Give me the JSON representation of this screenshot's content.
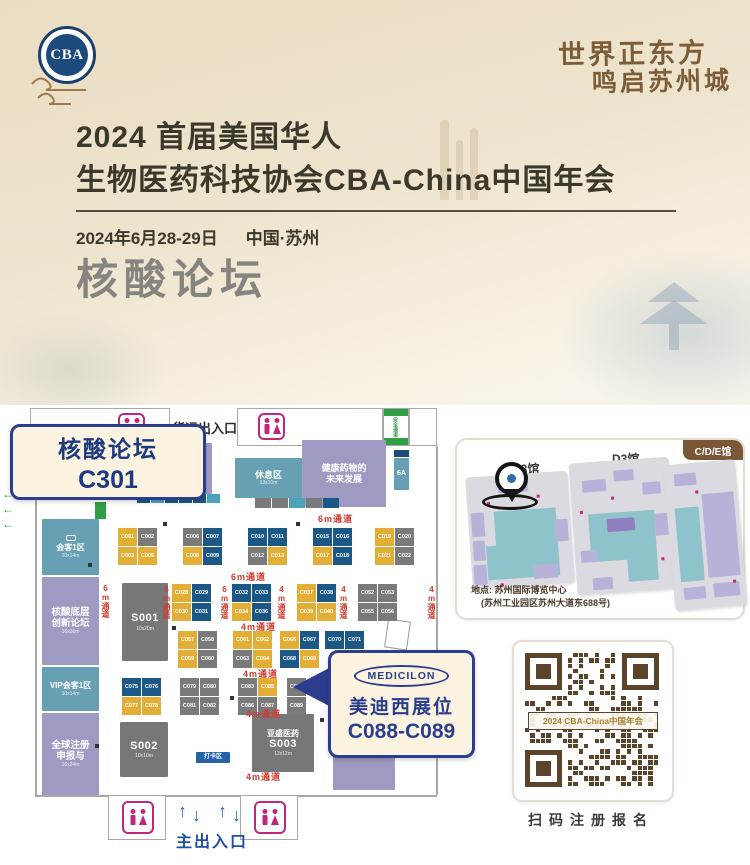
{
  "colors": {
    "accent_navy": "#2b3e8e",
    "booth_yellow": "#e3ae36",
    "booth_blue": "#1b5886",
    "booth_gray": "#7a7a7a",
    "zone_purple": "#9e9bc2",
    "zone_teal": "#66a0b2",
    "aisle_red": "#d23b2e",
    "green": "#2f9e44",
    "wc_pink": "#c0267c",
    "qr_brown": "#5a452a",
    "badge_brown": "#7a5837"
  },
  "icons": {
    "left_arrow": "←",
    "up_arrow": "↑",
    "down_arrow": "↓"
  },
  "header": {
    "logo": "CBA",
    "calligraphy": [
      "世界正东方",
      "鸣启苏州城"
    ],
    "title1": "2024 首届美国华人",
    "title2": "生物医药科技协会CBA-China中国年会",
    "date": "2024年6月28-29日",
    "city": "中国·苏州",
    "forum": "核酸论坛"
  },
  "floorplan": {
    "labels": {
      "freight": "货运出入口",
      "safety": "安全通道",
      "main_exit": "主出入口"
    },
    "callout": {
      "line1": "核酸论坛",
      "line2": "C301"
    },
    "medicilon": {
      "logo": "MEDICILON",
      "line1": "美迪西展位",
      "line2": "C088-C089"
    },
    "zones": [
      {
        "name": "zhongshan",
        "t": "中山大学 A联合体",
        "c": "C306",
        "s": "16x10m",
        "cls": "purple",
        "x": 115,
        "y": 38,
        "w": 97,
        "h": 51
      },
      {
        "name": "rest-area",
        "t": "休息区",
        "s": "13x10m",
        "cls": "teal",
        "x": 235,
        "y": 53,
        "w": 67,
        "h": 40
      },
      {
        "name": "future-forum",
        "t": "健康药物的未来发展",
        "cls": "purple",
        "x": 302,
        "y": 35,
        "w": 84,
        "h": 67
      },
      {
        "name": "meeting-1",
        "t": "会客1区",
        "s": "10x14m",
        "cls": "teal",
        "x": 42,
        "y": 114,
        "w": 57,
        "h": 56,
        "icon": "sofa"
      },
      {
        "name": "nucleic-bottom-forum",
        "t": "核酸底层创新论坛",
        "s": "16x26m",
        "cls": "purple",
        "x": 42,
        "y": 172,
        "w": 57,
        "h": 88
      },
      {
        "name": "vip-meeting",
        "t": "VIP会客1区",
        "s": "10x14m",
        "cls": "teal",
        "x": 42,
        "y": 262,
        "w": 57,
        "h": 44
      },
      {
        "name": "global-reg",
        "t": "全球注册申报与",
        "s": "16x24m",
        "cls": "purple",
        "x": 42,
        "y": 308,
        "w": 57,
        "h": 82
      },
      {
        "name": "s001",
        "c": "S001",
        "s": "10x20m",
        "cls": "gray",
        "x": 122,
        "y": 178,
        "w": 46,
        "h": 78
      },
      {
        "name": "s002",
        "c": "S002",
        "s": "10x10m",
        "cls": "gray",
        "x": 120,
        "y": 317,
        "w": 48,
        "h": 55
      },
      {
        "name": "s003",
        "t": "亚盛医药",
        "c": "S003",
        "s": "12x12m",
        "cls": "gray",
        "x": 252,
        "y": 309,
        "w": 62,
        "h": 58
      },
      {
        "name": "right-purple",
        "s": "14x24m",
        "cls": "purple",
        "x": 333,
        "y": 309,
        "w": 62,
        "h": 76
      },
      {
        "name": "checkin",
        "t": "打卡区",
        "cls": "blue",
        "x": 196,
        "y": 347,
        "w": 34,
        "h": 11
      },
      {
        "name": "tag-6a",
        "t": "6A",
        "cls": "teal",
        "x": 394,
        "y": 53,
        "w": 15,
        "h": 32
      }
    ],
    "clusters": [
      {
        "x": 118,
        "y": 123,
        "cols": 2,
        "cells": [
          [
            "C001",
            "y"
          ],
          [
            "C002",
            "g"
          ],
          [
            "C003",
            "y"
          ],
          [
            "C005",
            "y"
          ]
        ]
      },
      {
        "x": 183,
        "y": 123,
        "cols": 2,
        "cells": [
          [
            "C006",
            "g"
          ],
          [
            "C007",
            "n"
          ],
          [
            "C008",
            "y"
          ],
          [
            "C009",
            "n"
          ]
        ]
      },
      {
        "x": 248,
        "y": 123,
        "cols": 2,
        "cells": [
          [
            "C010",
            "n"
          ],
          [
            "C011",
            "n"
          ],
          [
            "C012",
            "g"
          ],
          [
            "C013",
            "y"
          ]
        ]
      },
      {
        "x": 313,
        "y": 123,
        "cols": 2,
        "cells": [
          [
            "C015",
            "n"
          ],
          [
            "C016",
            "n"
          ],
          [
            "C017",
            "y"
          ],
          [
            "C018",
            "n"
          ]
        ]
      },
      {
        "x": 375,
        "y": 123,
        "cols": 2,
        "cells": [
          [
            "C019",
            "y"
          ],
          [
            "C020",
            "g"
          ],
          [
            "C021",
            "y"
          ],
          [
            "C022",
            "g"
          ]
        ]
      },
      {
        "x": 172,
        "y": 179,
        "cols": 2,
        "cells": [
          [
            "C028",
            "y"
          ],
          [
            "C029",
            "n"
          ],
          [
            "C030",
            "y"
          ],
          [
            "C031",
            "n"
          ]
        ]
      },
      {
        "x": 232,
        "y": 179,
        "cols": 2,
        "cells": [
          [
            "C032",
            "n"
          ],
          [
            "C033",
            "n"
          ],
          [
            "C034",
            "y"
          ],
          [
            "C036",
            "n"
          ]
        ]
      },
      {
        "x": 297,
        "y": 179,
        "cols": 2,
        "cells": [
          [
            "C037",
            "y"
          ],
          [
            "C038",
            "n"
          ],
          [
            "C039",
            "y"
          ],
          [
            "C040",
            "y"
          ]
        ]
      },
      {
        "x": 358,
        "y": 179,
        "cols": 2,
        "cells": [
          [
            "C052",
            "g"
          ],
          [
            "C053",
            "g"
          ],
          [
            "C055",
            "g"
          ],
          [
            "C056",
            "g"
          ]
        ]
      },
      {
        "x": 178,
        "y": 226,
        "cols": 2,
        "cells": [
          [
            "C057",
            "y"
          ],
          [
            "C058",
            "g"
          ],
          [
            "C059",
            "y"
          ],
          [
            "C060",
            "g"
          ]
        ]
      },
      {
        "x": 233,
        "y": 226,
        "cols": 2,
        "cells": [
          [
            "C061",
            "y"
          ],
          [
            "C062",
            "y"
          ],
          [
            "C063",
            "g"
          ],
          [
            "C064",
            "y"
          ]
        ]
      },
      {
        "x": 280,
        "y": 226,
        "cols": 2,
        "cells": [
          [
            "C066",
            "y"
          ],
          [
            "C067",
            "n"
          ],
          [
            "C068",
            "n"
          ],
          [
            "C069",
            "y"
          ]
        ]
      },
      {
        "x": 325,
        "y": 226,
        "cols": 2,
        "cells": [
          [
            "C070",
            "n"
          ],
          [
            "C071",
            "n"
          ]
        ]
      },
      {
        "x": 122,
        "y": 273,
        "cols": 2,
        "cells": [
          [
            "C075",
            "n"
          ],
          [
            "C076",
            "n"
          ],
          [
            "C077",
            "y"
          ],
          [
            "C078",
            "y"
          ]
        ]
      },
      {
        "x": 180,
        "y": 273,
        "cols": 2,
        "cells": [
          [
            "C079",
            "g"
          ],
          [
            "C080",
            "g"
          ],
          [
            "C081",
            "g"
          ],
          [
            "C082",
            "g"
          ]
        ]
      },
      {
        "x": 238,
        "y": 273,
        "cols": 2,
        "cells": [
          [
            "C083",
            "g"
          ],
          [
            "C085",
            "y"
          ],
          [
            "C086",
            "g"
          ],
          [
            "C087",
            "g"
          ]
        ]
      },
      {
        "x": 287,
        "y": 273,
        "cols": 1,
        "cells": [
          [
            "C088",
            "g"
          ],
          [
            "C089",
            "g"
          ]
        ]
      }
    ],
    "aisles_h": [
      {
        "text": "6m通道",
        "x": 318,
        "y": 107
      },
      {
        "text": "6m通道",
        "x": 231,
        "y": 165
      },
      {
        "text": "4m通道",
        "x": 241,
        "y": 215
      },
      {
        "text": "4m通道",
        "x": 243,
        "y": 262
      },
      {
        "text": "4m通道",
        "x": 246,
        "y": 302
      },
      {
        "text": "4m通道",
        "x": 246,
        "y": 365
      }
    ],
    "aisles_v": [
      {
        "text": "6m通道",
        "x": 101,
        "y": 179
      },
      {
        "text": "6m通道",
        "x": 162,
        "y": 180
      },
      {
        "text": "6m通道",
        "x": 220,
        "y": 180
      },
      {
        "text": "4m通道",
        "x": 277,
        "y": 180
      },
      {
        "text": "4m通道",
        "x": 339,
        "y": 180
      },
      {
        "text": "4m通道",
        "x": 427,
        "y": 180
      }
    ],
    "strips": [
      {
        "x": 137,
        "y": 89,
        "cw": 13,
        "ch": 9,
        "cells": [
          "n",
          "t",
          "n",
          "n",
          "n",
          "t"
        ]
      },
      {
        "x": 255,
        "y": 93,
        "cw": 16,
        "ch": 10,
        "cells": [
          "g",
          "g",
          "t",
          "g",
          "n"
        ]
      }
    ],
    "markers": [
      [
        163,
        117
      ],
      [
        296,
        117
      ],
      [
        88,
        158
      ],
      [
        172,
        221
      ],
      [
        230,
        291
      ],
      [
        320,
        313
      ],
      [
        95,
        339
      ]
    ]
  },
  "venue_map": {
    "badge": "C/D/E馆",
    "halls": [
      "C3馆",
      "D3馆",
      "E3馆"
    ],
    "address1": "地点: 苏州国际博览中心",
    "address2": "(苏州工业园区苏州大道东688号)"
  },
  "qr": {
    "banner": "2024 CBA-China中国年会",
    "caption": "扫码注册报名"
  }
}
